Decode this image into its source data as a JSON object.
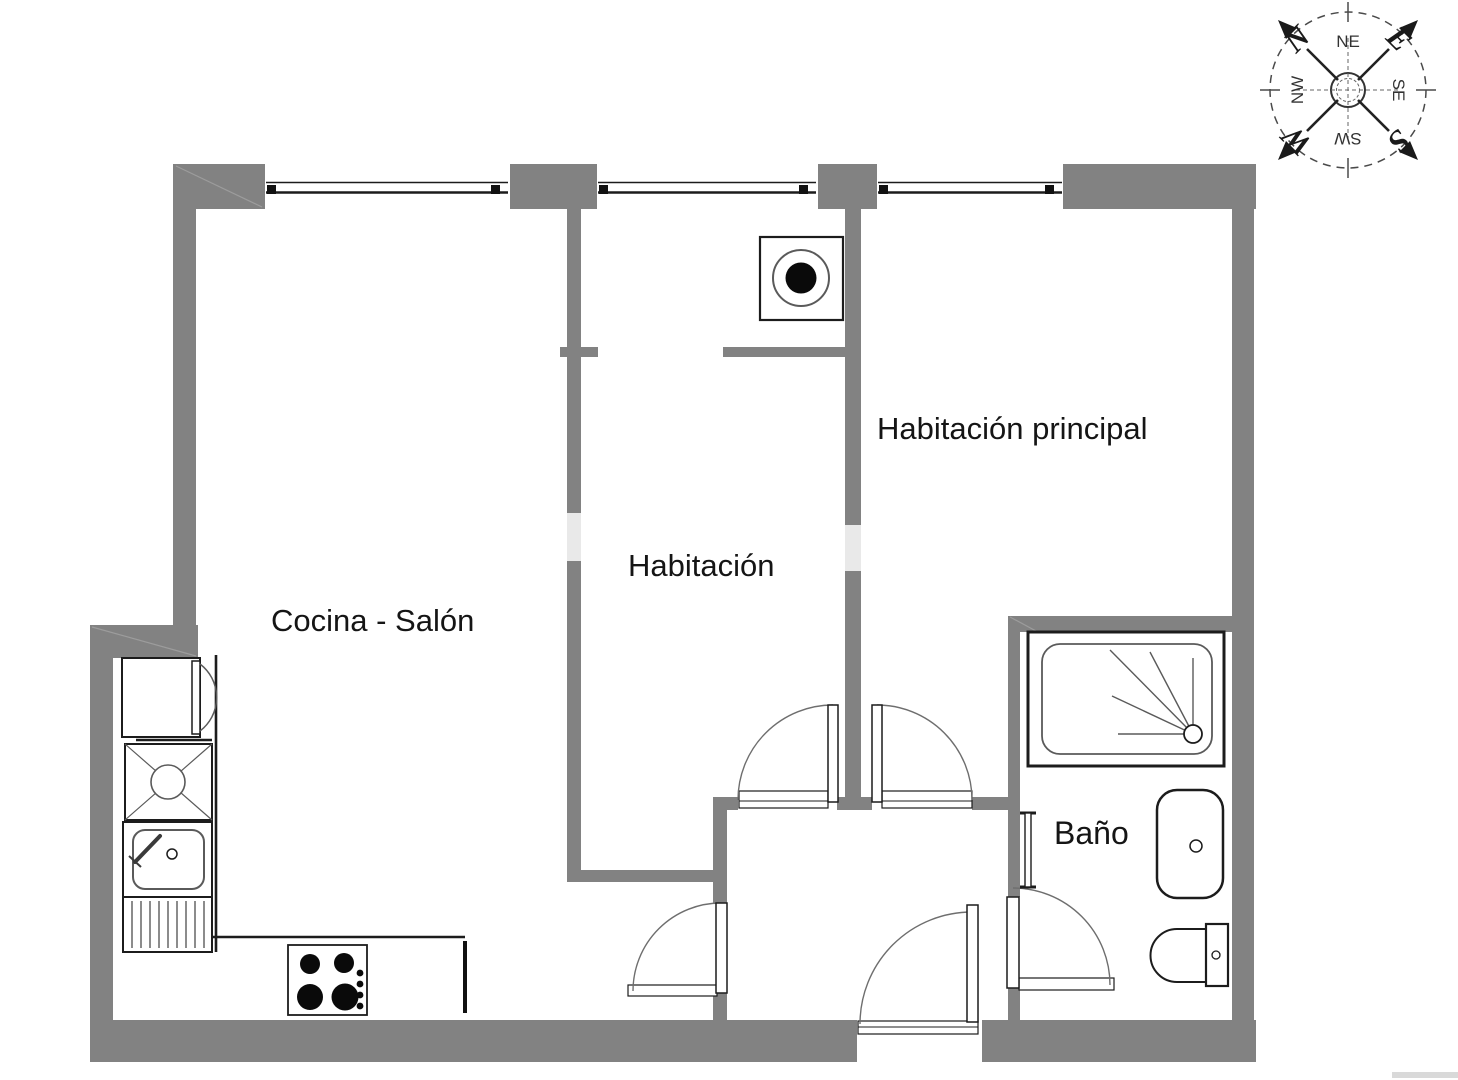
{
  "labels": {
    "cocina_salon": "Cocina - Salón",
    "habitacion": "Habitación",
    "habitacion_principal": "Habitación principal",
    "bano": "Baño"
  },
  "compass": {
    "n": "N",
    "ne": "NE",
    "e": "E",
    "se": "SE",
    "s": "S",
    "sw": "SW",
    "w": "W",
    "nw": "NW"
  },
  "colors": {
    "wall": "#828282",
    "line": "#1c1c1c",
    "label_text": "#151515",
    "watermark": "#e9e9e9"
  }
}
